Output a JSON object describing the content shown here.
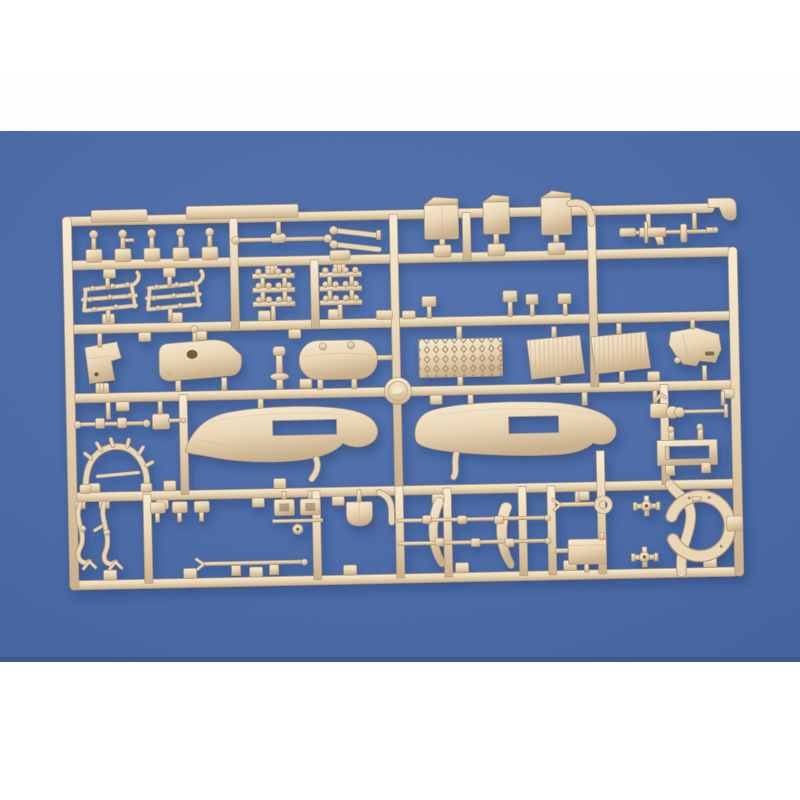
{
  "scene": {
    "type": "product photograph",
    "subject": "tan injection-molded plastic model kit sprue on a blue paper backdrop",
    "backdrop": "blue paper with white bands above and below",
    "plastic_color_name": "tan",
    "backdrop_color_name": "blue",
    "part_groups": [
      "lever posts",
      "tow axle rod",
      "tapered horn rods",
      "stowage canisters",
      "machine gun",
      "hook tool",
      "ladder racks",
      "pioneer tool clusters",
      "angled bracket plate",
      "engine block",
      "plunger bolt",
      "fuel tank",
      "tread-plate grille",
      "louvered panels",
      "cab panel",
      "logo roundel",
      "small axle",
      "pin bracket",
      "canopy bow frame",
      "left fender",
      "right fender",
      "cable winch",
      "stowage rack frame",
      "hose straps",
      "small brackets",
      "tie rod",
      "clamp brackets",
      "shovel",
      "leaf springs",
      "spring rods",
      "wrench tool",
      "stowage box",
      "pipe crosses",
      "ring mount"
    ]
  },
  "colors": {
    "paper": "#ffffff",
    "blue_light": "#5373ae",
    "blue_mid": "#4a6aa6",
    "blue_dark": "#40609b",
    "blue_edge": "#35507f",
    "tan": "#e9d6b6",
    "tan_light": "#f6ebd2",
    "tan_dark": "#c9b08c",
    "tan_deep": "#a98f6d",
    "outline": "#b49a76",
    "detail_dark": "#6e5b44",
    "cast_shadow": "#1c355f"
  }
}
